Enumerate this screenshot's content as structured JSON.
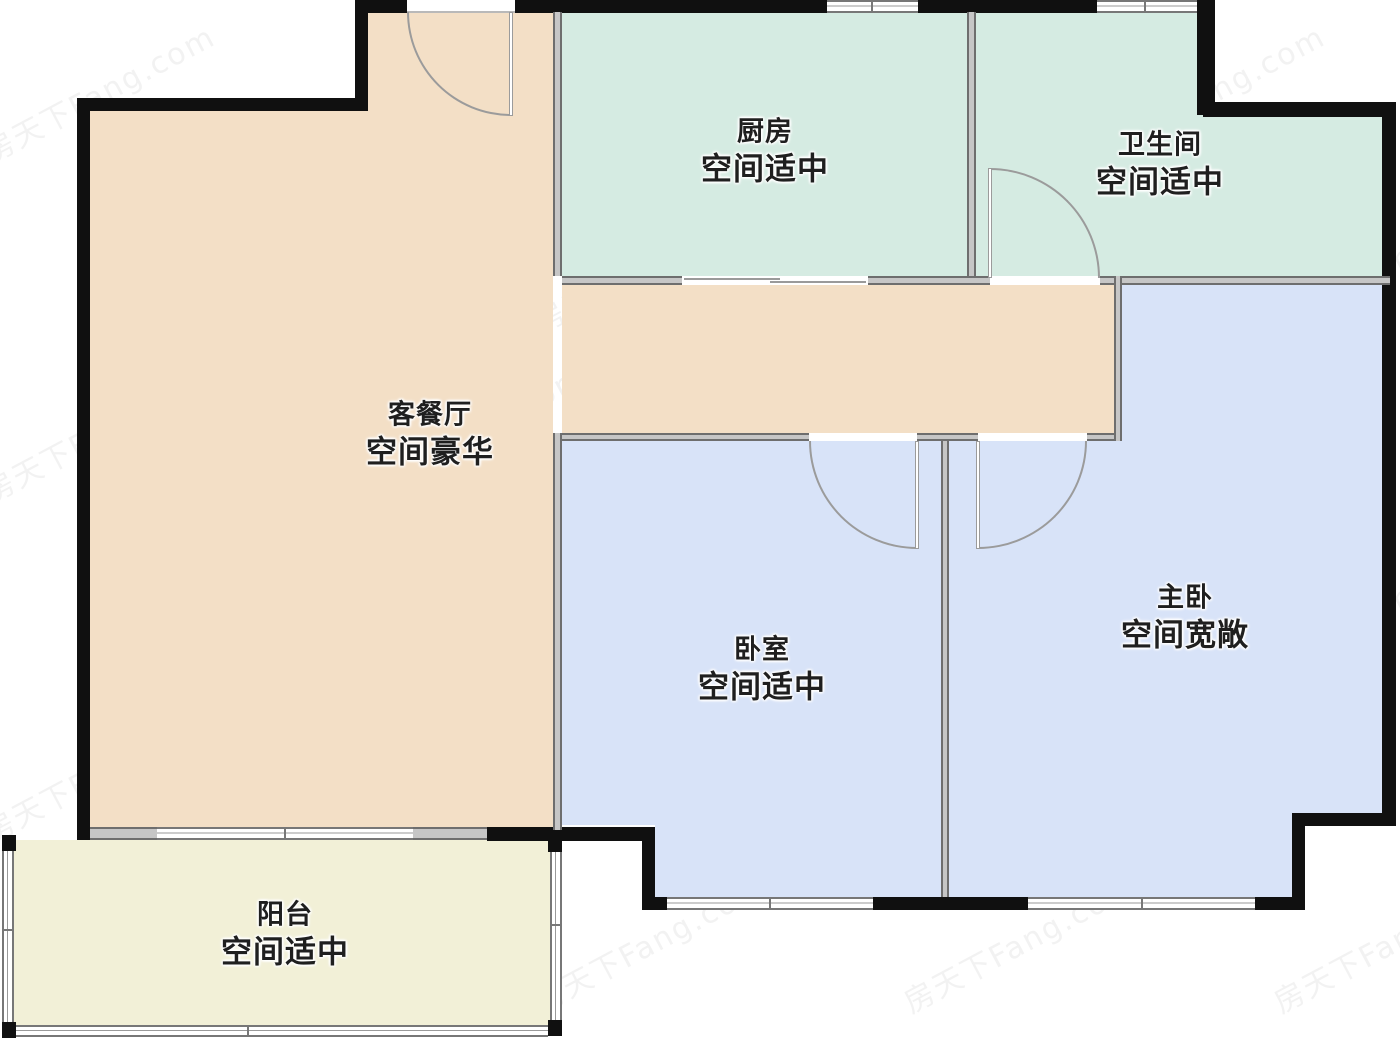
{
  "rooms": [
    {
      "id": "kitchen",
      "name": "厨房",
      "desc": "空间适中"
    },
    {
      "id": "bathroom",
      "name": "卫生间",
      "desc": "空间适中"
    },
    {
      "id": "living",
      "name": "客餐厅",
      "desc": "空间豪华"
    },
    {
      "id": "bedroom",
      "name": "卧室",
      "desc": "空间适中"
    },
    {
      "id": "master",
      "name": "主卧",
      "desc": "空间宽敞"
    },
    {
      "id": "balcony",
      "name": "阳台",
      "desc": "空间适中"
    }
  ],
  "watermark": {
    "text": "房天下Fang.com"
  },
  "colors": {
    "kitchen": "#d5ebe2",
    "bathroom": "#d5ebe2",
    "living_dining": "#f3dfc6",
    "bedroom": "#d8e3f8",
    "master_bedroom": "#d8e3f8",
    "balcony": "#f2f0d7",
    "exterior_wall": "#101010",
    "interior_wall": "#c6c6c6",
    "door_arc": "#9b9b9b",
    "label_text": "#1f1f1f"
  }
}
